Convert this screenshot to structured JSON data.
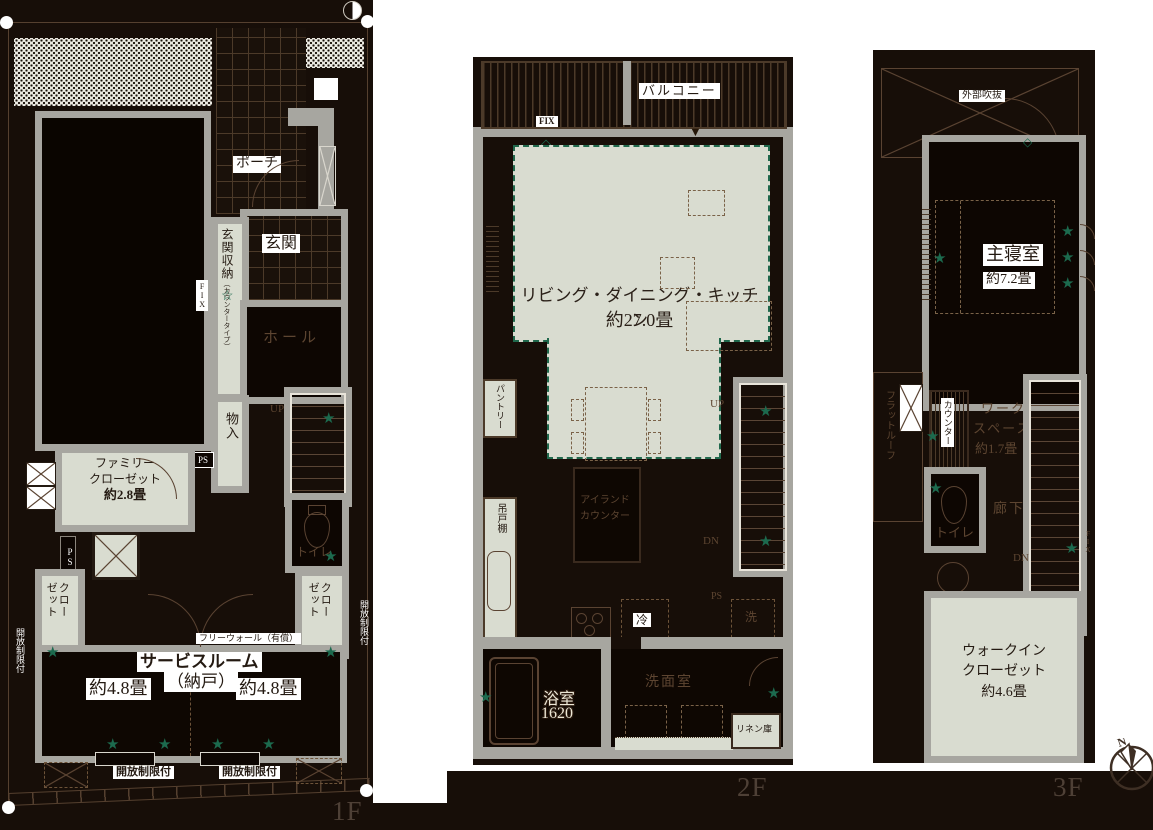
{
  "title": "3-story house floor plan",
  "colors": {
    "page_background": "#ffffff",
    "plan_background": "#170e08",
    "wall_gray": "#a7a6a0",
    "room_sage": "#d9dcd0",
    "accent_green": "#1c6a4e",
    "line_brown": "#5a4332",
    "text_brown": "#5d4531",
    "floor_label_brown": "#4e4036",
    "bath_text_cream": "#ece7d6"
  },
  "icons": {
    "star": "★",
    "star_outline": "☆",
    "diamond": "◇",
    "triangle_down": "▼",
    "north": "N"
  },
  "floors": {
    "f1": {
      "floor_label": "1F",
      "porch": "ポーチ",
      "entrance": "玄関",
      "entrance_storage": "玄関収納",
      "entrance_storage_sub": "（カウンタータイプ）",
      "fix": "FIX",
      "hall": "ホール",
      "up": "UP",
      "storage": "物入",
      "ps": "PS",
      "family_closet_line1": "ファミリー",
      "family_closet_line2": "クローゼット",
      "family_closet_size": "約2.8畳",
      "toilet": "トイレ",
      "closet_line1": "クロー",
      "closet_line2": "ゼット",
      "service_room": "サービスルーム",
      "service_room_sub": "（納戸）",
      "service_size_left": "約4.8畳",
      "service_size_right": "約4.8畳",
      "free_wall": "フリーウォール（有償）",
      "open_limit": "開放制限付"
    },
    "f2": {
      "floor_label": "2F",
      "balcony": "バルコニー",
      "fix": "FIX",
      "ldk": "リビング・ダイニング・キッチン",
      "ldk_size": "約27.0畳",
      "pantry": "パントリー",
      "hanging_cupboard": "吊戸棚",
      "island_line1": "アイランド",
      "island_line2": "カウンター",
      "up": "UP",
      "dn": "DN",
      "ps": "PS",
      "fridge": "冷",
      "washer": "洗",
      "washroom": "洗面室",
      "bath": "浴室",
      "bath_size": "1620",
      "linen": "リネン庫"
    },
    "f3": {
      "floor_label": "3F",
      "outer_void": "外部吹抜",
      "bedroom": "主寝室",
      "bedroom_size": "約7.2畳",
      "flat_roof": "フラットルーフ",
      "counter": "カウンター",
      "workspace_line1": "ワーク",
      "workspace_line2": "スペース",
      "workspace_size": "約1.7畳",
      "toilet": "トイレ",
      "hallway": "廊下",
      "dn": "DN",
      "fix": "FIX",
      "wic_line1": "ウォークイン",
      "wic_line2": "クローゼット",
      "wic_size": "約4.6畳"
    }
  }
}
